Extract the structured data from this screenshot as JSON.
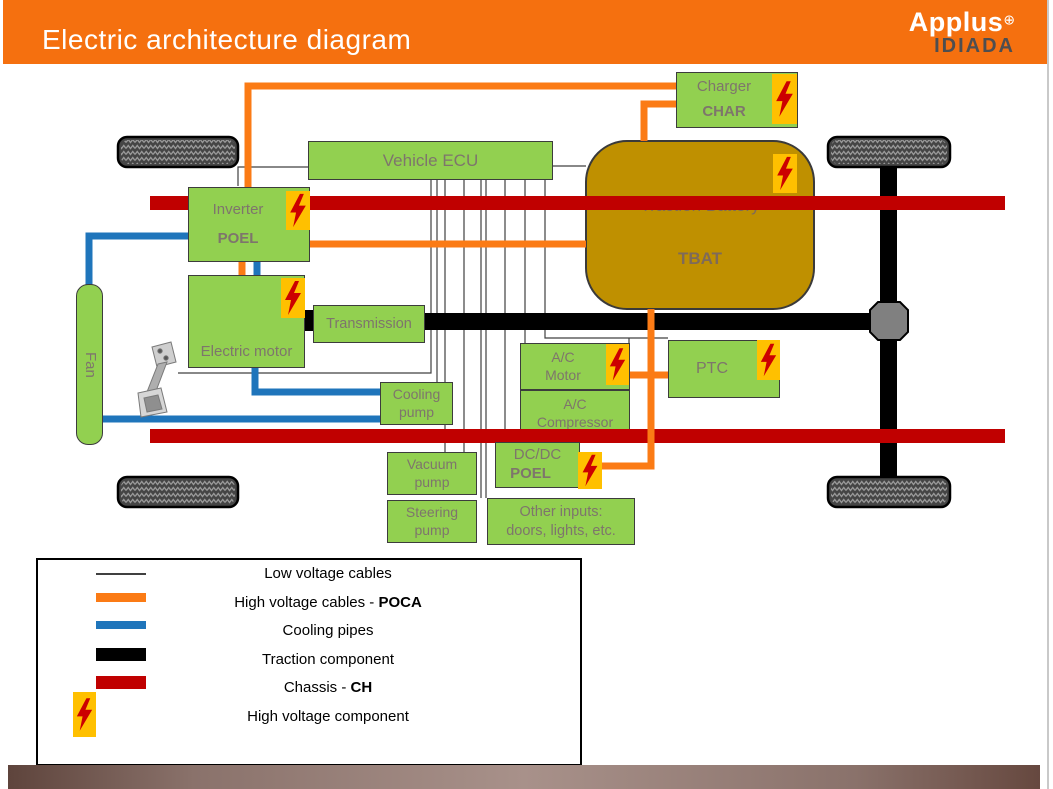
{
  "header": {
    "title": "Electric architecture diagram",
    "logo": {
      "name": "Applus",
      "plus": "⊕",
      "sub": "IDIADA"
    }
  },
  "components": {
    "vehicle_ecu": {
      "label": "Vehicle ECU"
    },
    "inverter": {
      "label": "Inverter",
      "code": "POEL"
    },
    "electric_motor": {
      "label": "Electric motor"
    },
    "transmission": {
      "label": "Transmission"
    },
    "charger": {
      "label": "Charger",
      "code": "CHAR"
    },
    "traction_battery": {
      "label": "Traction Battery",
      "code": "TBAT"
    },
    "fan": {
      "label": "Fan"
    },
    "cooling_pump": {
      "line1": "Cooling",
      "line2": "pump"
    },
    "vacuum_pump": {
      "line1": "Vacuum",
      "line2": "pump"
    },
    "steering_pump": {
      "line1": "Steering",
      "line2": "pump"
    },
    "dcdc": {
      "label": "DC/DC",
      "code": "POEL"
    },
    "other_inputs": {
      "line1": "Other inputs:",
      "line2": "doors, lights, etc."
    },
    "ac_motor": {
      "line1": "A/C",
      "line2": "Motor"
    },
    "ac_compressor": {
      "line1": "A/C",
      "line2": "Compressor"
    },
    "ptc": {
      "label": "PTC"
    }
  },
  "legend": {
    "items": [
      {
        "label": "Low voltage cables",
        "code": ""
      },
      {
        "label": "High voltage cables - ",
        "code": "POCA"
      },
      {
        "label": "Cooling pipes",
        "code": ""
      },
      {
        "label": "Traction component",
        "code": ""
      },
      {
        "label": "Chassis - ",
        "code": "CH"
      },
      {
        "label": "High voltage component",
        "code": ""
      }
    ]
  },
  "colors": {
    "header_orange": "#F5700F",
    "component_green": "#92D050",
    "battery_gold": "#BF9000",
    "badge_yellow": "#FFC000",
    "bolt_red": "#CC0000",
    "high_voltage_cable": "#FB7B15",
    "cooling_pipe": "#1F75BB",
    "traction": "#000000",
    "chassis_red": "#C00000",
    "low_voltage": "#404040"
  }
}
